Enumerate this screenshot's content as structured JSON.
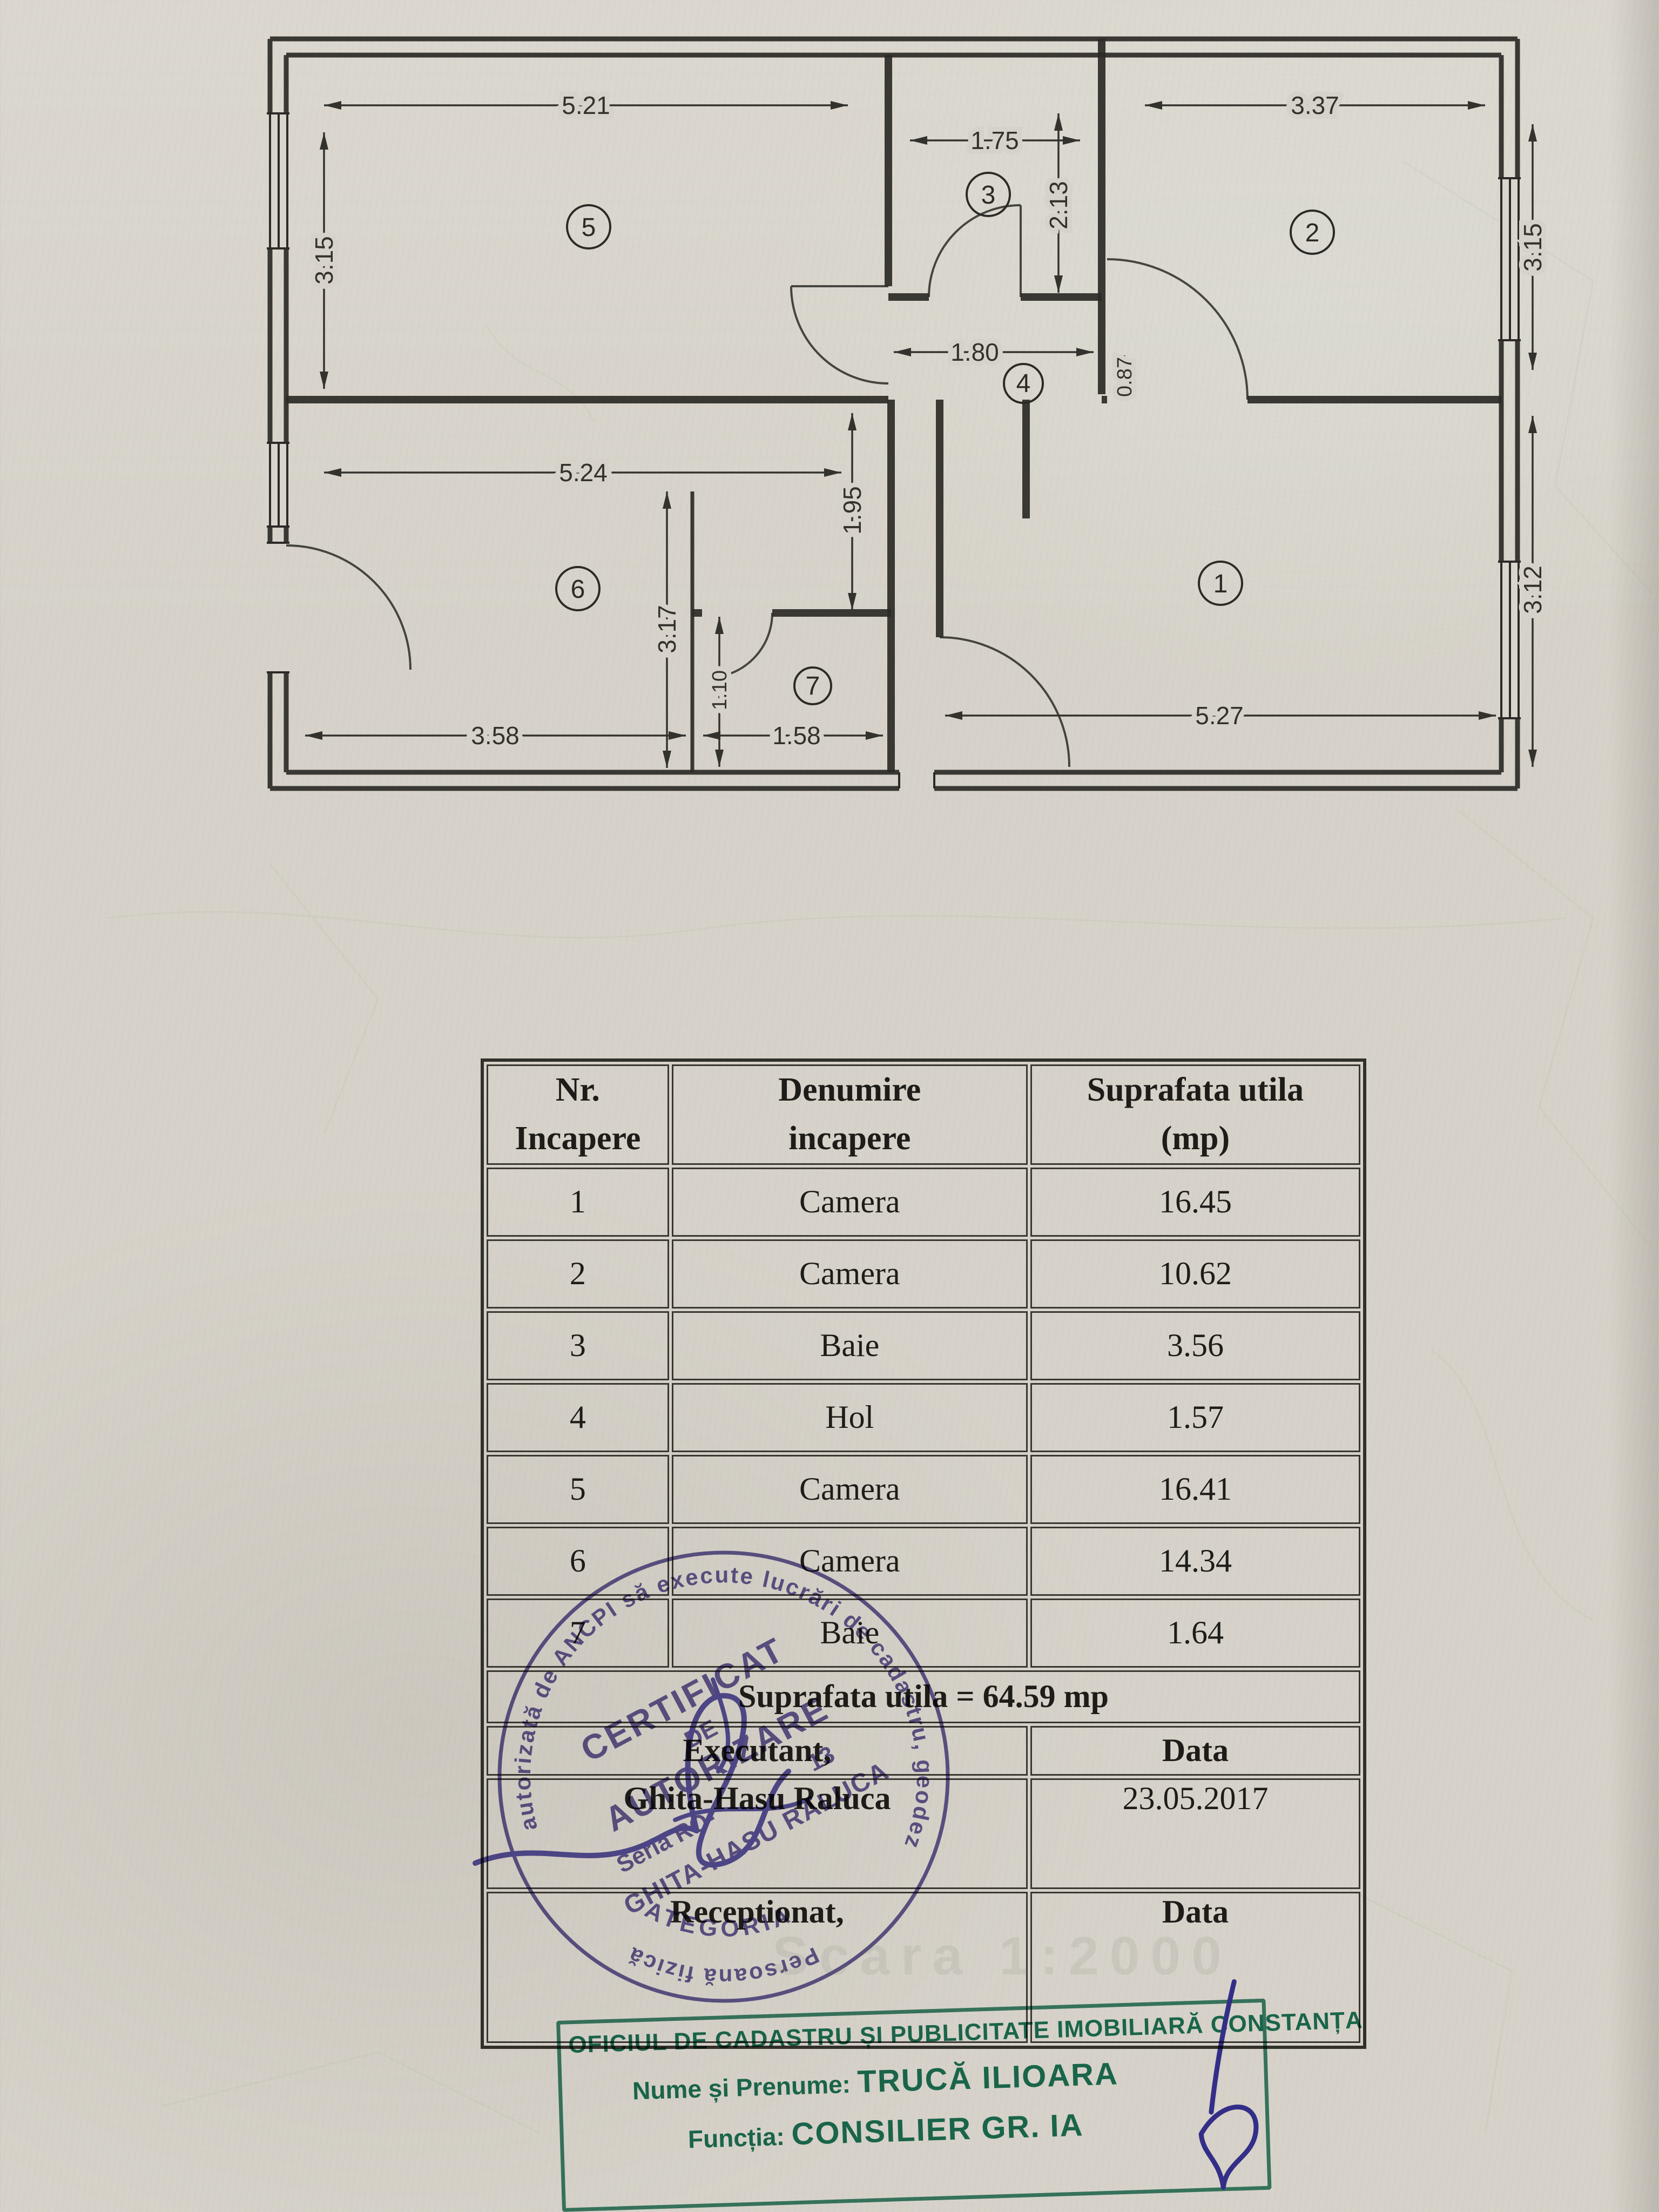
{
  "plan": {
    "room_labels": {
      "r1": "1",
      "r2": "2",
      "r3": "3",
      "r4": "4",
      "r5": "5",
      "r6": "6",
      "r7": "7"
    },
    "dims": {
      "r5_top": "5.21",
      "r5_left": "3.15",
      "r3_top": "1.75",
      "r3_right": "2.13",
      "r2_top": "3.37",
      "r2_right": "3.15",
      "hall_w": "1.80",
      "hall_h": "0.87",
      "r6_top": "5.24",
      "mid_v": "1.95",
      "r6_v": "3.17",
      "r1_right": "3.12",
      "r7_left": "1.10",
      "r7_bottom": "1.58",
      "r6_bottom": "3.58",
      "r1_bottom": "5.27"
    }
  },
  "table": {
    "col1_header_line1": "Nr.",
    "col1_header_line2": "Incapere",
    "col2_header_line1": "Denumire",
    "col2_header_line2": "incapere",
    "col3_header_line1": "Suprafata utila",
    "col3_header_line2": "(mp)",
    "rows": [
      {
        "nr": "1",
        "name": "Camera",
        "area": "16.45"
      },
      {
        "nr": "2",
        "name": "Camera",
        "area": "10.62"
      },
      {
        "nr": "3",
        "name": "Baie",
        "area": "3.56"
      },
      {
        "nr": "4",
        "name": "Hol",
        "area": "1.57"
      },
      {
        "nr": "5",
        "name": "Camera",
        "area": "16.41"
      },
      {
        "nr": "6",
        "name": "Camera",
        "area": "14.34"
      },
      {
        "nr": "7",
        "name": "Baie",
        "area": "1.64"
      }
    ],
    "total": "Suprafata utila = 64.59 mp",
    "executant_label": "Executant,",
    "data_label": "Data",
    "executant_name": "Ghita-Hasu Raluca",
    "date": "23.05.2017",
    "receptionat_label": "Receptionat,",
    "data_label2": "Data"
  },
  "round_stamp": {
    "ring_main": "autorizată de ANCPI să execute lucrări de cadastru, geodezie și cartografie",
    "ring_bottom": "Persoană fizică",
    "line1": "CERTIFICAT",
    "line2": "DE",
    "line3": "AUTORIZARE",
    "seria_prefix": "Seria RO-",
    "seria_suffix": "13",
    "name": "GHITA-HASU RALUCA",
    "category": "CATEGORIA B"
  },
  "office_stamp": {
    "line1": "OFICIUL DE CADASTRU ȘI PUBLICITATE IMOBILIARĂ CONSTANȚA",
    "name_label": "Nume și Prenume:",
    "name_value": "TRUCĂ ILIOARA",
    "function_label": "Funcția:",
    "function_value": "CONSILIER GR. IA"
  },
  "ghost": {
    "scale_text": "Scara 1:2000"
  }
}
